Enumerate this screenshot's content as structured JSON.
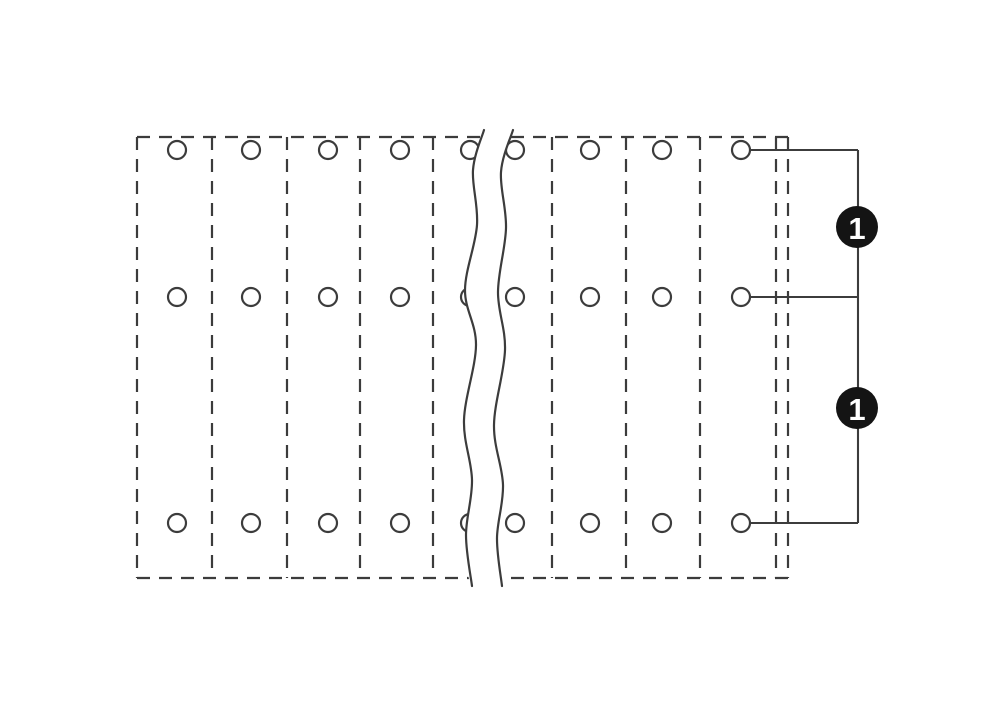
{
  "page": {
    "background": "#ffffff"
  },
  "diagram": {
    "title": "terminal-strip-top-view",
    "line_color": "#3c3c3c",
    "housing": {
      "x1": 137,
      "y1": 137,
      "x2": 788,
      "y2": 578,
      "dash": "13 9",
      "stroke_width": 2.2
    },
    "separators_x": [
      212,
      287,
      360,
      433,
      552,
      626,
      700,
      776
    ],
    "holes": {
      "columns_x": [
        177,
        251,
        328,
        400,
        470,
        515,
        590,
        662,
        741
      ],
      "rows_y": [
        150,
        297,
        523
      ],
      "radius": 9,
      "stroke_width": 2.2,
      "fill": "#ffffff"
    },
    "break_band": {
      "fill": "#ffffff",
      "stroke_width": 2.2,
      "left_points": [
        [
          484,
          130
        ],
        [
          473,
          170
        ],
        [
          477,
          225
        ],
        [
          465,
          290
        ],
        [
          476,
          345
        ],
        [
          464,
          420
        ],
        [
          472,
          480
        ],
        [
          466,
          535
        ],
        [
          472,
          586
        ]
      ],
      "right_points": [
        [
          513,
          130
        ],
        [
          501,
          172
        ],
        [
          506,
          228
        ],
        [
          498,
          292
        ],
        [
          505,
          350
        ],
        [
          494,
          425
        ],
        [
          503,
          485
        ],
        [
          497,
          538
        ],
        [
          502,
          586
        ]
      ]
    },
    "callout": {
      "stroke_width": 2.1,
      "leader_start_x": 750,
      "junction_x": 858,
      "leader_rows_y": [
        150,
        297,
        523
      ],
      "badge_radius": 21,
      "badge_fill": "#141414",
      "badge_text_color": "#ffffff",
      "badge_font_size": 31,
      "badges": [
        {
          "label": "1",
          "cx": 857,
          "cy": 227
        },
        {
          "label": "1",
          "cx": 857,
          "cy": 408
        }
      ]
    }
  }
}
